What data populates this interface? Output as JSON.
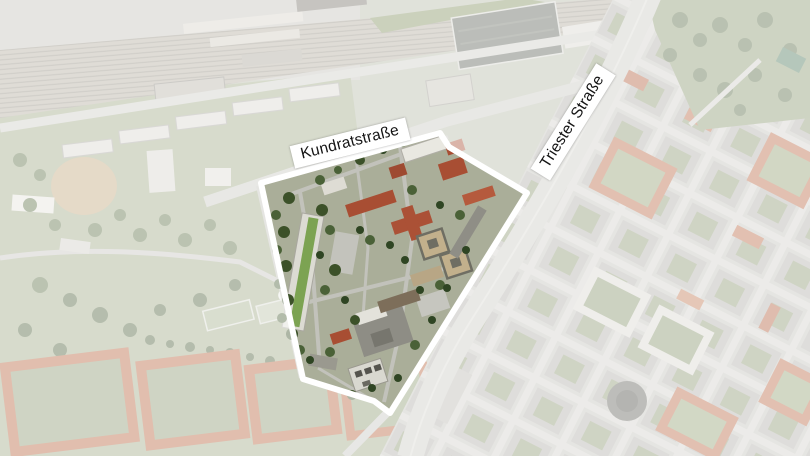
{
  "map": {
    "street_labels": [
      {
        "id": "kundratstrasse",
        "text": "Kundratstraße"
      },
      {
        "id": "triester-strasse",
        "text": "Triester Straße"
      }
    ],
    "highlight": {
      "outline_color": "#ffffff",
      "outline_width": "6",
      "fade_opacity": "0.58",
      "polygon_points": "261,183 440,133 449,147 527,193 390,413 374,401 303,379"
    },
    "label_colors": {
      "background": "#ffffff",
      "text": "#141414"
    }
  }
}
